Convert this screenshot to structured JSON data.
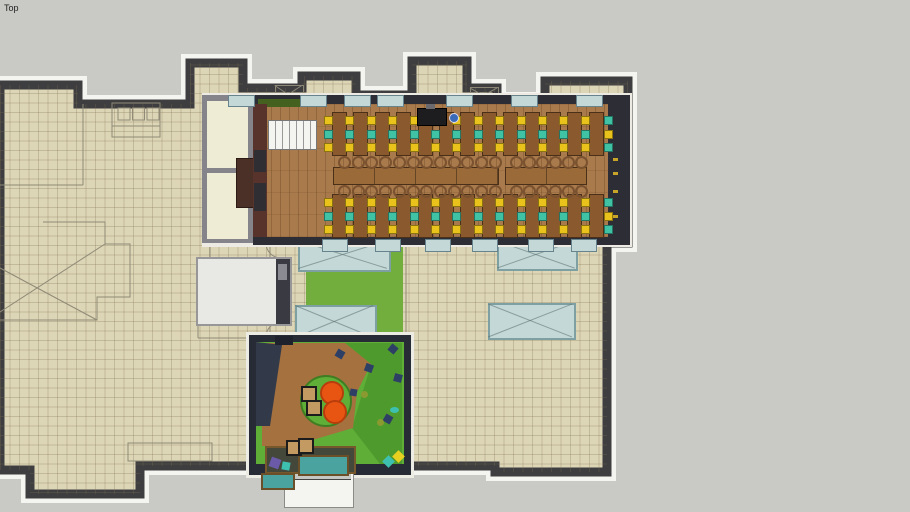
{
  "viewport": {
    "view_label": "Top"
  },
  "colors": {
    "canvas": "#c9c9c5",
    "floor_tile": "#dcd5b6",
    "wall_dark": "#3e3e40",
    "outline_white": "#f4f4f1",
    "wood": "#a87a4c",
    "desk": "#8a5a2e",
    "desk_border": "#4a3018",
    "table": "#9a6a39",
    "ring_chair": "#7a5230",
    "glass": "#c3d8d7",
    "glass_frame": "#7fa0a2",
    "lawn": "#72ae3e",
    "play_green": "#5fae37",
    "pouf_orange": "#e85512",
    "chair_yellow": "#e9c21c",
    "chair_teal": "#3fc3a4",
    "wall_text_yellow": "#c8a428",
    "pond_teal": "#4aa39e"
  },
  "scene": {
    "desk": {
      "x_start": 332,
      "step": 21.4,
      "count": 13,
      "w": 13,
      "h": 42
    },
    "desk_rows": [
      {
        "y": 112
      },
      {
        "y": 194
      }
    ],
    "chair": {
      "size": 7,
      "offsets": [
        4,
        18,
        31
      ],
      "left_colors": [
        "#e9c21c",
        "#3fc3a4",
        "#e9c21c"
      ],
      "right_colors": [
        "#3fc3a4",
        "#e9c21c",
        "#3fc3a4"
      ]
    },
    "long_tables": [
      {
        "x": 333,
        "y": 167,
        "w": 164,
        "h": 16,
        "chairs": 12,
        "c_start": 338,
        "c_step": 13.7
      },
      {
        "x": 505,
        "y": 167,
        "w": 80,
        "h": 16,
        "chairs": 6,
        "c_start": 510,
        "c_step": 13
      }
    ],
    "window_tabs": {
      "w": 25,
      "h": 10,
      "top_y": 95,
      "bottom_y": 239,
      "top_x": [
        228,
        300,
        344,
        377,
        446,
        511,
        576
      ],
      "bottom_x": [
        322,
        375,
        425,
        472,
        528,
        571
      ]
    },
    "skylights": [
      [
        298,
        240,
        89,
        28
      ],
      [
        497,
        240,
        77,
        27
      ],
      [
        295,
        305,
        78,
        32
      ],
      [
        488,
        303,
        84,
        33
      ]
    ],
    "roof_xboxes": [
      [
        275,
        85,
        27,
        18
      ],
      [
        470,
        87,
        27,
        15
      ]
    ],
    "wall_dashes": [
      [
        613,
        158
      ],
      [
        613,
        172
      ],
      [
        613,
        190
      ],
      [
        613,
        215
      ]
    ],
    "equipment": {
      "x": 417,
      "y": 108,
      "w": 28,
      "h": 16
    },
    "person": {
      "x": 449,
      "y": 113,
      "d": 8,
      "c": "#3a6ab8"
    },
    "play_items": [
      {
        "n": "walkway",
        "x": 265,
        "y": 446,
        "w": 87,
        "h": 24,
        "c": "#44483a",
        "b": "#76582c"
      },
      {
        "n": "pond",
        "x": 298,
        "y": 455,
        "w": 47,
        "h": 17,
        "c": "#4aa39e",
        "b": "#6b4f28"
      },
      {
        "n": "pond-small",
        "x": 261,
        "y": 473,
        "w": 30,
        "h": 13,
        "c": "#4aa39e",
        "b": "#6b4f28"
      },
      {
        "n": "rug-circle",
        "x": 300,
        "y": 375,
        "w": 48,
        "h": 48,
        "c": "#5fae37",
        "b": "#3f7d22",
        "rnd": 1
      },
      {
        "n": "pouf",
        "x": 320,
        "y": 381,
        "w": 20,
        "h": 20,
        "c": "#e85512",
        "b": "#b93c0c",
        "rnd": 1
      },
      {
        "n": "pouf",
        "x": 323,
        "y": 400,
        "w": 20,
        "h": 20,
        "c": "#e85512",
        "b": "#b93c0c",
        "rnd": 1
      },
      {
        "n": "cube-seat",
        "x": 301,
        "y": 386,
        "w": 12,
        "h": 12,
        "c": "#c29a62",
        "b": "#1c1c1c"
      },
      {
        "n": "cube-seat",
        "x": 306,
        "y": 400,
        "w": 12,
        "h": 12,
        "c": "#c29a62",
        "b": "#1c1c1c"
      },
      {
        "n": "cube-seat",
        "x": 286,
        "y": 440,
        "w": 12,
        "h": 12,
        "c": "#c29a62",
        "b": "#1c1c1c"
      },
      {
        "n": "cube-seat",
        "x": 298,
        "y": 438,
        "w": 12,
        "h": 12,
        "c": "#c29a62",
        "b": "#1c1c1c"
      },
      {
        "n": "climb-hold",
        "x": 336,
        "y": 350,
        "w": 8,
        "h": 8,
        "c": "#2e3f66",
        "rot": 30
      },
      {
        "n": "climb-hold",
        "x": 365,
        "y": 364,
        "w": 8,
        "h": 8,
        "c": "#2e3f66",
        "rot": 20
      },
      {
        "n": "climb-hold",
        "x": 389,
        "y": 345,
        "w": 8,
        "h": 8,
        "c": "#2e3f66",
        "rot": 40
      },
      {
        "n": "climb-hold",
        "x": 394,
        "y": 374,
        "w": 8,
        "h": 8,
        "c": "#2e3f66",
        "rot": 15
      },
      {
        "n": "climb-hold",
        "x": 384,
        "y": 415,
        "w": 8,
        "h": 8,
        "c": "#2e3f66",
        "rot": 30
      },
      {
        "n": "climb-hold",
        "x": 350,
        "y": 389,
        "w": 7,
        "h": 7,
        "c": "#2e3f66",
        "rot": 10
      },
      {
        "n": "toy",
        "x": 361,
        "y": 391,
        "w": 7,
        "h": 7,
        "c": "#8a9a30",
        "rnd": 1
      },
      {
        "n": "toy",
        "x": 377,
        "y": 419,
        "w": 7,
        "h": 7,
        "c": "#8a9a30",
        "rnd": 1
      },
      {
        "n": "toy",
        "x": 390,
        "y": 407,
        "w": 9,
        "h": 6,
        "c": "#3ec0b0",
        "rnd": 1
      },
      {
        "n": "toy",
        "x": 384,
        "y": 457,
        "w": 9,
        "h": 9,
        "c": "#3ec0b0",
        "rot": 45
      },
      {
        "n": "toy",
        "x": 394,
        "y": 452,
        "w": 9,
        "h": 9,
        "c": "#e8d020",
        "rot": 45
      },
      {
        "n": "toy",
        "x": 270,
        "y": 458,
        "w": 10,
        "h": 10,
        "c": "#6a5aa8",
        "rot": 20
      },
      {
        "n": "toy",
        "x": 282,
        "y": 462,
        "w": 8,
        "h": 8,
        "c": "#3ec0b0",
        "rot": 10
      },
      {
        "n": "door-block",
        "x": 275,
        "y": 336,
        "w": 18,
        "h": 9,
        "c": "#1e222c"
      }
    ]
  }
}
